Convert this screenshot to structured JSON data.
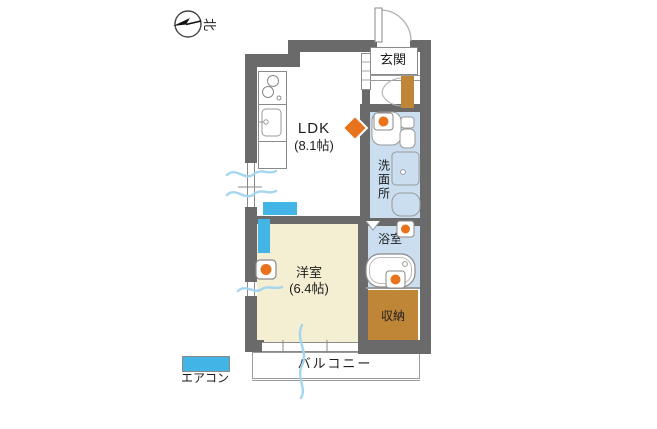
{
  "plan": {
    "compass": {
      "north_label": "北"
    },
    "rooms": {
      "genkan": {
        "label": "玄関"
      },
      "ldk": {
        "label": "LDK",
        "size": "(8.1帖)"
      },
      "washroom": {
        "label": "洗面所"
      },
      "bathroom": {
        "label": "浴室"
      },
      "western_room": {
        "label": "洋室",
        "size": "(6.4帖)"
      },
      "storage": {
        "label": "収納"
      },
      "balcony": {
        "label": "バルコニー"
      }
    },
    "legend": {
      "aircon": {
        "label": "エアコン",
        "color": "#42b4e6"
      }
    },
    "colors": {
      "wall": "#6a6a6a",
      "wet_room_floor": "#cadef0",
      "western_room_floor": "#f4efd3",
      "storage_fill": "#bf8637",
      "aircon_fill": "#42b4e6",
      "marker_orange": "#e8731c",
      "breeze_line": "#a5d6f0"
    }
  }
}
